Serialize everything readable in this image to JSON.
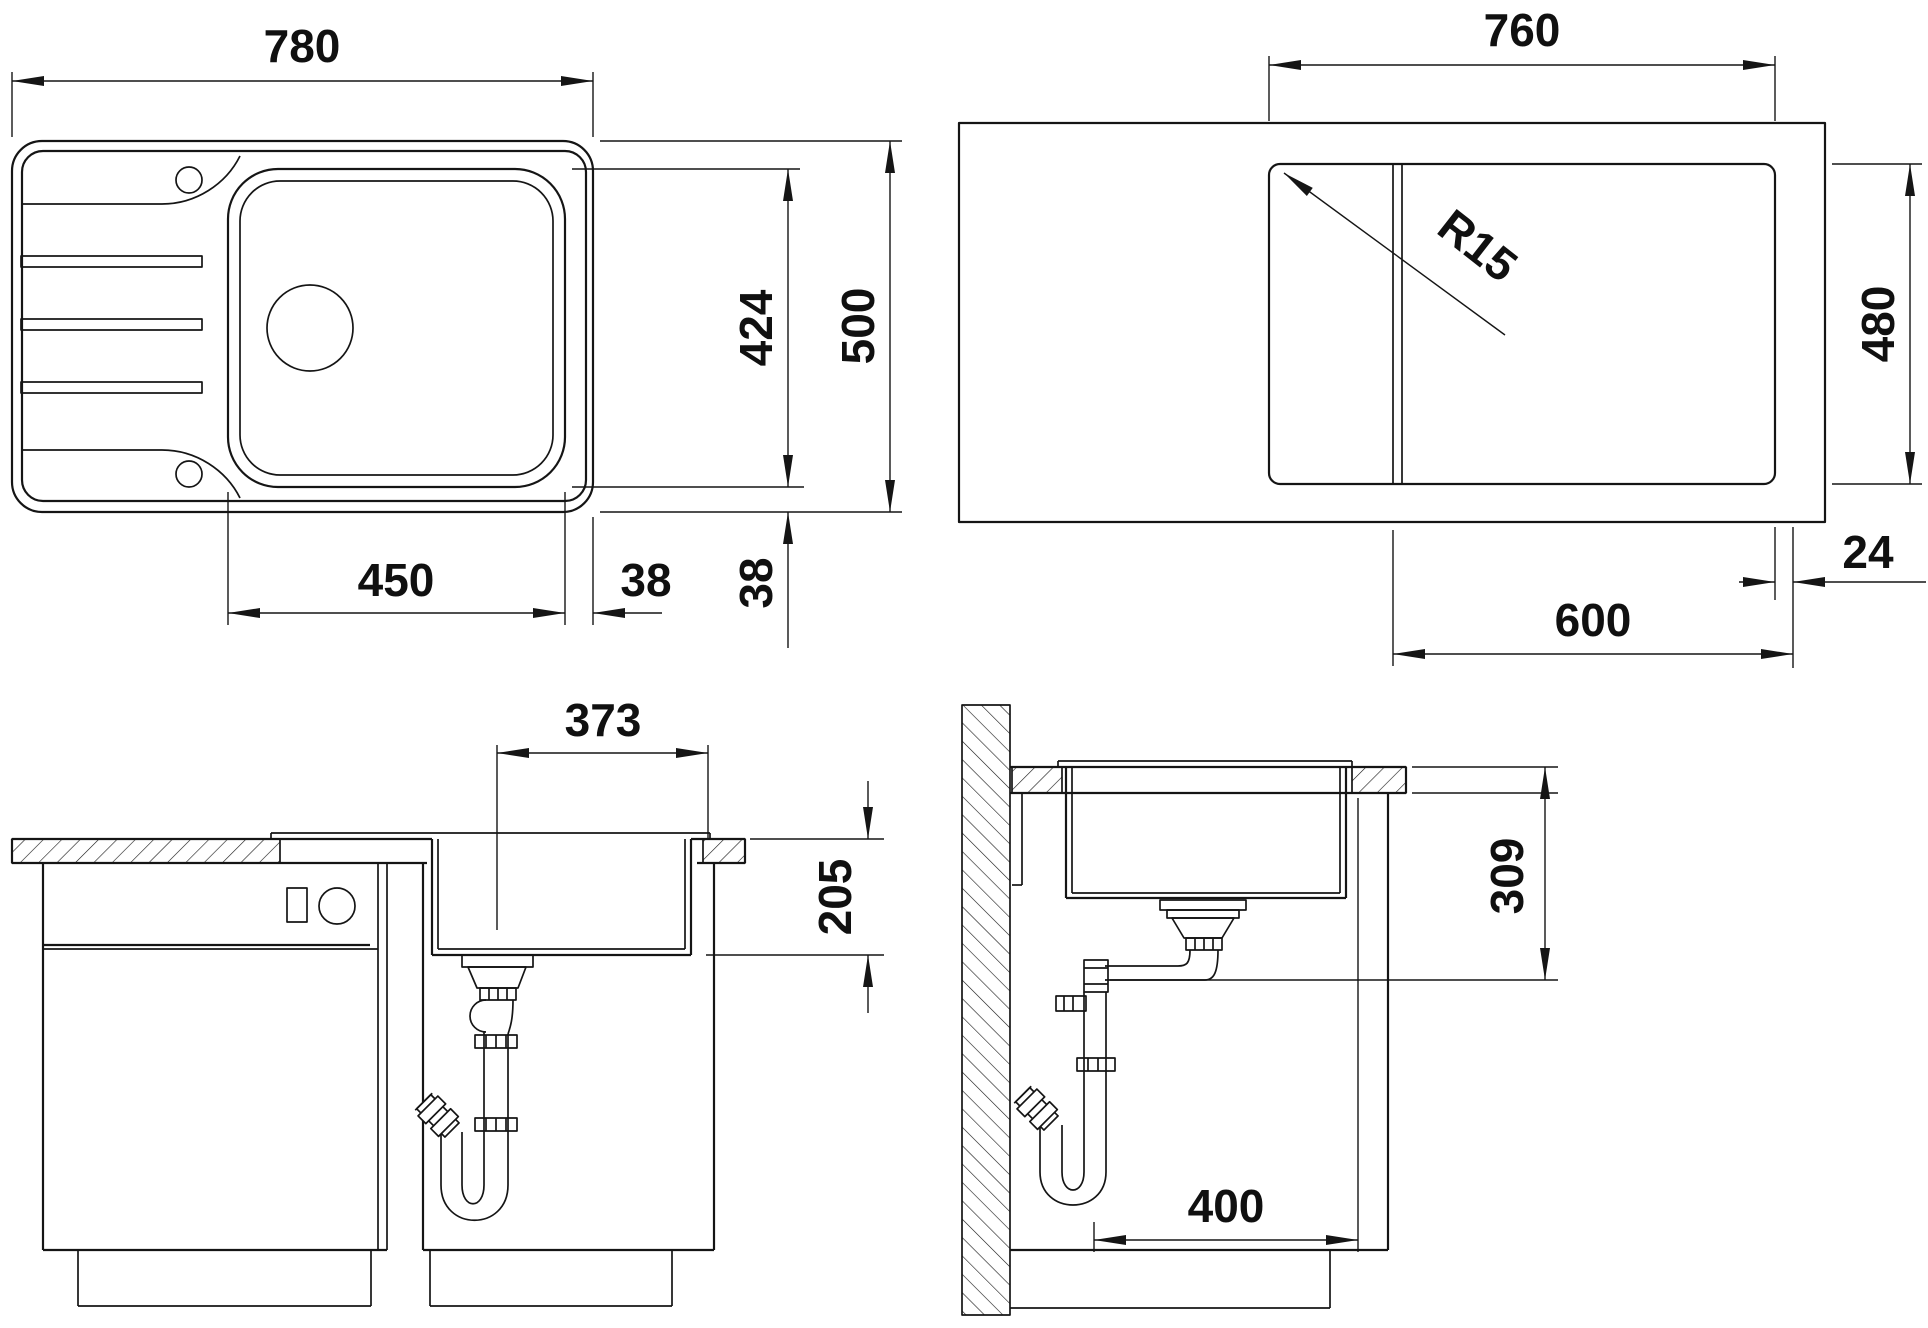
{
  "drawing": {
    "type": "sink installation dimension drawing",
    "line_color": "#151515",
    "background": "#ffffff",
    "views": {
      "sink_plan": {
        "overall_width": "780",
        "bowl_width": "450",
        "edge_gap_right": "38",
        "edge_gap_bottom": "38",
        "bowl_front_to_back": "424",
        "overall_depth": "500"
      },
      "cutout_plan": {
        "cutout_width": "760",
        "corner_radius": "R15",
        "cutout_depth": "480",
        "front_overhang": "24",
        "cabinet_width": "600"
      },
      "front_section": {
        "drain_to_edge": "373",
        "bowl_depth": "205"
      },
      "side_section": {
        "installation_depth": "309",
        "min_cabinet_depth": "400"
      }
    }
  }
}
